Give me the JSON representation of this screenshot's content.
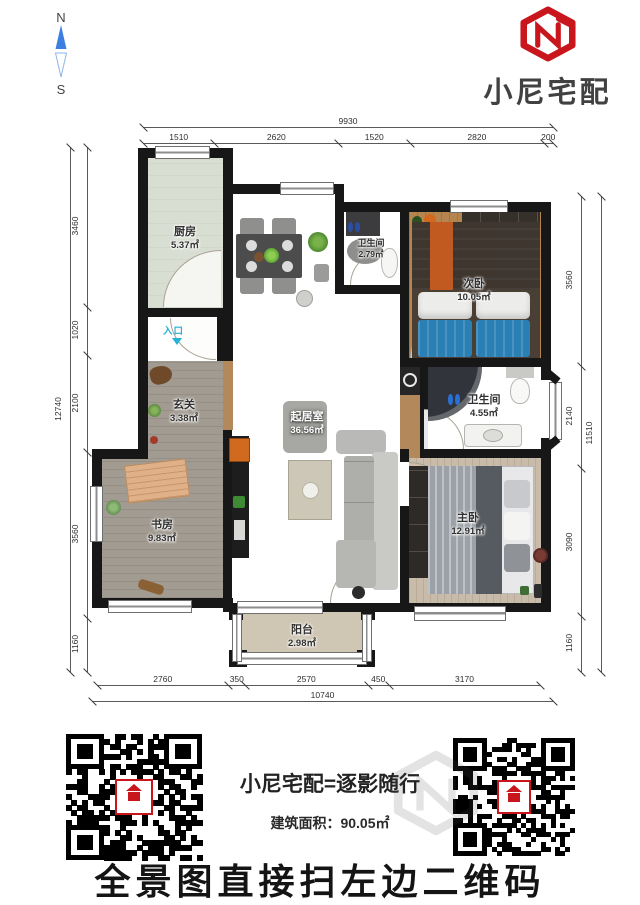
{
  "compass": {
    "north": "N",
    "south": "S"
  },
  "brand": {
    "name": "小尼宅配"
  },
  "plan": {
    "entrance_label": "入口",
    "rooms": [
      {
        "id": "kitchen",
        "name": "厨房",
        "area": "5.37㎡"
      },
      {
        "id": "bath_top",
        "name": "卫生间",
        "area": "2.79㎡"
      },
      {
        "id": "bedroom_second",
        "name": "次卧",
        "area": "10.05㎡"
      },
      {
        "id": "hallway",
        "name": "玄关",
        "area": "3.38㎡"
      },
      {
        "id": "living_room",
        "name": "起居室",
        "area": "36.56㎡"
      },
      {
        "id": "bath_right",
        "name": "卫生间",
        "area": "4.55㎡"
      },
      {
        "id": "study",
        "name": "书房",
        "area": "9.83㎡"
      },
      {
        "id": "master_bedroom",
        "name": "主卧",
        "area": "12.91㎡"
      },
      {
        "id": "balcony",
        "name": "阳台",
        "area": "2.98㎡"
      }
    ],
    "dimensions": {
      "top_overall": "9930",
      "top_segments": [
        "1510",
        "2620",
        "1520",
        "2820",
        "200"
      ],
      "left_overall": "12740",
      "left_segments": [
        "3460",
        "1020",
        "2100",
        "3560",
        "1160"
      ],
      "right_overall": "11510",
      "right_segments": [
        "3560",
        "2140",
        "3090",
        "1160"
      ],
      "bottom_overall": "10740",
      "bottom_segments": [
        "2760",
        "350",
        "2570",
        "450",
        "3170"
      ]
    }
  },
  "footer": {
    "slogan": "小尼宅配=逐影随行",
    "area_label": "建筑面积：",
    "area_value": "90.05㎡",
    "cta": "全景图直接扫左边二维码"
  },
  "colors": {
    "brand_red": "#c9151c",
    "compass_blue": "#3d7fe0",
    "entrance_cyan": "#25b2d4"
  }
}
